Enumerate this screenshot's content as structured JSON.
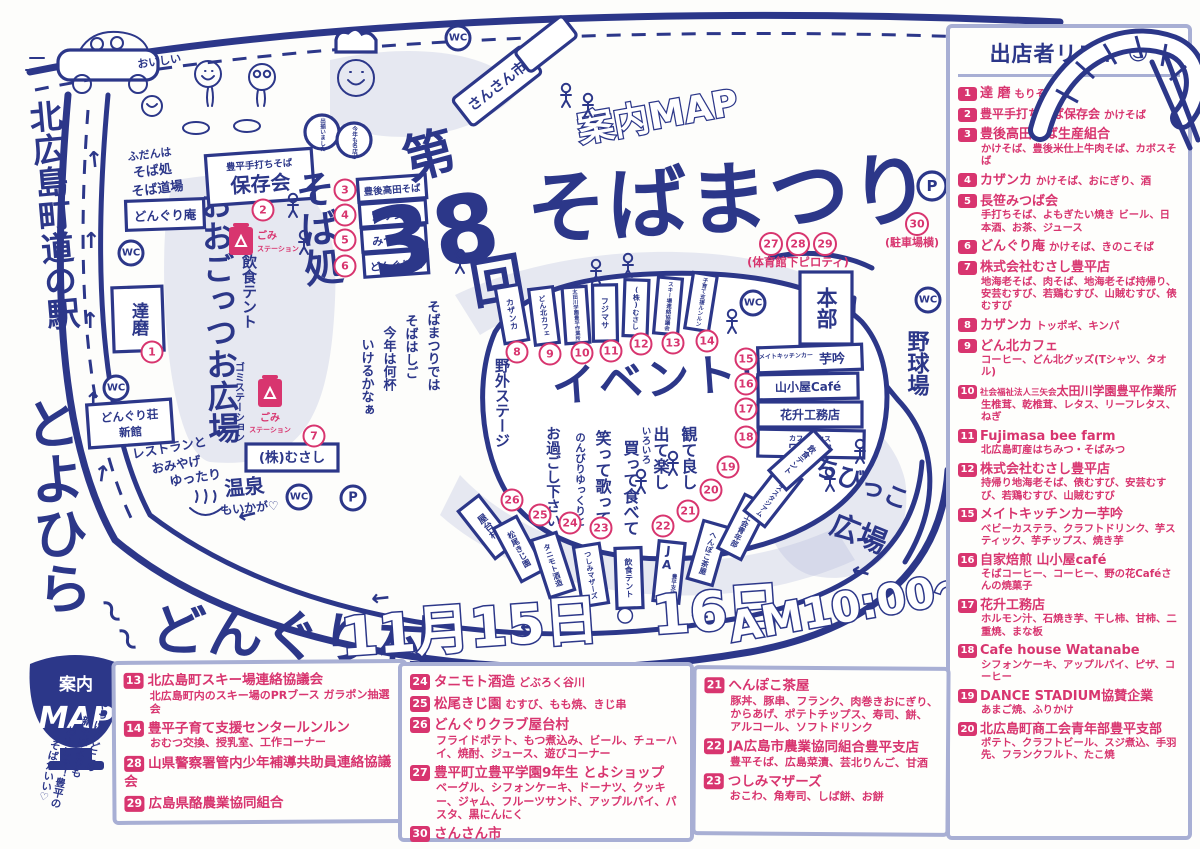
{
  "nums": [
    "1",
    "2",
    "3",
    "4",
    "5",
    "6",
    "7",
    "8",
    "9",
    "10",
    "11",
    "12",
    "13",
    "14",
    "15",
    "16",
    "17",
    "18",
    "19",
    "20",
    "21",
    "22",
    "23",
    "24",
    "25",
    "26",
    "27",
    "28",
    "29",
    "30"
  ],
  "title": {
    "annai": "案内MAP",
    "dai": "第",
    "no": "38",
    "kai": "回",
    "name": "そばまつり",
    "gym_note": "(体育館下ピロティ)",
    "parking_note": "(駐車場横)",
    "dates": "11月15日・16日",
    "time": "AM10:00〜"
  },
  "legend": {
    "bowl_line1": "案内",
    "bowl_line2": "MAP",
    "tag1": "やっぱりどこの",
    "tag2": "新そばよりも",
    "tag3": "わたしゃ！豊平の",
    "tag4": "そばがいい♡"
  },
  "station": {
    "l1": "北広島町道の駅",
    "l2": "とよひら",
    "l3": "どんぐり村",
    "sq": "〜"
  },
  "map": {
    "wc": "WC",
    "p": "P",
    "fudan1": "ふだんは",
    "fudan2": "そば処",
    "fudan3": "そば道場",
    "donguri_an": "どんぐり庵",
    "daruma": "達磨",
    "shinkan1": "どんぐり荘",
    "shinkan2": "新館",
    "rest1": "レストランと",
    "rest2": "おみやげ",
    "onsen1": "ゆったり",
    "onsen2": "温泉",
    "onsen3": "もいかが♡",
    "musashi": "(株)むさし",
    "oogottsuo": "おおごっつお広場",
    "insyoku": "飲食テント",
    "gomi_blue": "ゴミステーション",
    "gomi1": "ごみ",
    "gomi2": "ステーション",
    "hozonkai_s": "豊平手打ちそば",
    "hozonkai": "保存会",
    "sobadokoro": "そば処",
    "stall3": "豊後高田そば",
    "stall4": "カザンカ",
    "stall5": "みつば会",
    "stall6": "どんぐり庵",
    "sp1": "そばまつりでは",
    "sp2": "そばはしご",
    "sp3": "今年は何杯",
    "sp4": "いけるかなぁ",
    "chef1": "今年も名店が",
    "chef2": "出揃いました",
    "car_sp": "おいしい",
    "sansan": "さんさん市",
    "yagai": "野外ステージ",
    "event": "イベント広場",
    "b8": "カザンカ",
    "b9": "どん北カフェ",
    "b10": "太田川学園豊平作業所",
    "b11": "フジマサ",
    "b12": "(株)むさし",
    "b13": "スキー場連絡協議会",
    "b14": "子育て支援ルンルン",
    "honbu": "本部",
    "yakyujo": "野球場",
    "chibikko1": "ちびっこ",
    "chibikko2": "広場",
    "s15a": "メイトキッチンカー",
    "s15b": "芋吟",
    "s16": "山小屋Café",
    "s17": "花升工務店",
    "s18a": "カフェハウス",
    "s18b": "ワタナベ",
    "m1": "観て良し",
    "m2": "出て楽し",
    "m3": "いろいろ",
    "m4": "買って食べて",
    "m5": "笑って歌って",
    "m6": "のんびりゆっくりと",
    "m7": "お過ごし下さい",
    "bb19": "ダンススタジアム",
    "bb20": "商工会青年部",
    "bb21": "へんぽこ茶屋",
    "bb22a": "JA",
    "bb22b": "豊平支店",
    "bb23": "つしみマザーズ",
    "bb24": "タニモト酒造",
    "bb25": "松尾きじ園",
    "bb26": "屋台村"
  },
  "vendor_list": {
    "title": "出店者リスト",
    "smiley": "☺",
    "items": [
      {
        "num": "1",
        "name": "達 磨",
        "inline": "もりそば",
        "desc": ""
      },
      {
        "num": "2",
        "name": "豊平手打ちそば保存会",
        "inline": "かけそば",
        "desc": ""
      },
      {
        "num": "3",
        "name": "豊後高田そば生産組合",
        "inline": "",
        "desc": "かけそば、豊後米仕上牛肉そば、カボスそば"
      },
      {
        "num": "4",
        "name": "カザンカ",
        "inline": "かけそば、おにぎり、酒",
        "desc": ""
      },
      {
        "num": "5",
        "name": "長笹みつば会",
        "inline": "",
        "desc": "手打ちそば、よもぎたい焼き ビール、日本酒、お茶、ジュース"
      },
      {
        "num": "6",
        "name": "どんぐり庵",
        "inline": "かけそば、きのこそば",
        "desc": ""
      },
      {
        "num": "7",
        "name": "株式会社むさし豊平店",
        "inline": "",
        "desc": "地海老そば、肉そば、地海老そば持帰り、安芸むすび、若鶏むすび、山賊むすび、俵むすび"
      },
      {
        "num": "8",
        "name": "カザンカ",
        "inline": "トッポギ、キンパ",
        "desc": ""
      },
      {
        "num": "9",
        "name": "どん北カフェ",
        "inline": "",
        "desc": "コーヒー、どん北グッズ(Tシャツ、タオル)"
      },
      {
        "num": "10",
        "pre": "社会福祉法人三矢会",
        "name": "太田川学園豊平作業所",
        "inline": "",
        "desc": "生椎茸、乾椎茸、レタス、リーフレタス、ねぎ"
      },
      {
        "num": "11",
        "name": "Fujimasa bee farm",
        "inline": "",
        "desc": "北広島町産はちみつ・そばみつ"
      },
      {
        "num": "12",
        "name": "株式会社むさし豊平店",
        "inline": "",
        "desc": "持帰り地海老そば、俵むすび、安芸むすび、若鶏むすび、山賊むすび"
      },
      {
        "num": "15",
        "name": "メイトキッチンカー芋吟",
        "inline": "",
        "desc": "ベビーカステラ、クラフトドリンク、芋スティック、芋チップス、焼き芋"
      },
      {
        "num": "16",
        "name": "自家焙煎 山小屋café",
        "inline": "",
        "desc": "そばコーヒー、コーヒー、野の花Caféさんの焼菓子"
      },
      {
        "num": "17",
        "name": "花升工務店",
        "inline": "",
        "desc": "ホルモン汁、石焼き芋、干し柿、甘柿、二重焼、まな板"
      },
      {
        "num": "18",
        "name": "Cafe house Watanabe",
        "inline": "",
        "desc": "シフォンケーキ、アップルパイ、ピザ、コーヒー"
      },
      {
        "num": "19",
        "name": "DANCE STADIUM協賛企業",
        "inline": "",
        "desc": "あまご焼、ふりかけ"
      },
      {
        "num": "20",
        "name": "北広島町商工会青年部豊平支部",
        "inline": "",
        "desc": "ポテト、クラフトビール、スジ煮込、手羽先、フランクフルト、たこ焼"
      }
    ]
  },
  "box_a": {
    "items": [
      {
        "num": "13",
        "name": "北広島町スキー場連絡協議会",
        "inline": "",
        "desc": "北広島町内のスキー場のPRブース ガラポン抽選会"
      },
      {
        "num": "14",
        "name": "豊平子育て支援センタールンルン",
        "inline": "",
        "desc": "おむつ交換、授乳室、工作コーナー"
      },
      {
        "num": "28",
        "name": "山県警察署管内少年補導共助員連絡協議会",
        "inline": "",
        "desc": ""
      },
      {
        "num": "29",
        "name": "広島県酪農業協同組合",
        "inline": "",
        "desc": ""
      }
    ]
  },
  "box_b": {
    "items": [
      {
        "num": "24",
        "name": "タニモト酒造",
        "inline": "どぶろく谷川",
        "desc": ""
      },
      {
        "num": "25",
        "name": "松尾きじ園",
        "inline": "むすび、もも焼、きじ串",
        "desc": ""
      },
      {
        "num": "26",
        "name": "どんぐりクラブ屋台村",
        "inline": "",
        "desc": "フライドポテト、もつ煮込み、ビール、チューハイ、焼酎、ジュース、遊びコーナー"
      },
      {
        "num": "27",
        "name": "豊平町立豊平学園9年生 とよショップ",
        "inline": "",
        "desc": "ベーグル、シフォンケーキ、ドーナツ、クッキー、ジャム、フルーツサンド、アップルパイ、パスタ、黒にんにく"
      },
      {
        "num": "30",
        "name": "さんさん市",
        "inline": "",
        "desc": ""
      }
    ]
  },
  "box_c": {
    "items": [
      {
        "num": "21",
        "name": "へんぽこ茶屋",
        "inline": "",
        "desc": "豚丼、豚串、フランク、肉巻きおにぎり、からあげ、ポテトチップス、寿司、餅、アルコール、ソフトドリンク"
      },
      {
        "num": "22",
        "name": "JA広島市農業協同組合豊平支店",
        "inline": "",
        "desc": "豊平そば、広島菜漬、芸北りんご、甘酒"
      },
      {
        "num": "23",
        "name": "つしみマザーズ",
        "inline": "",
        "desc": "おこわ、角寿司、しば餅、お餅"
      }
    ]
  }
}
